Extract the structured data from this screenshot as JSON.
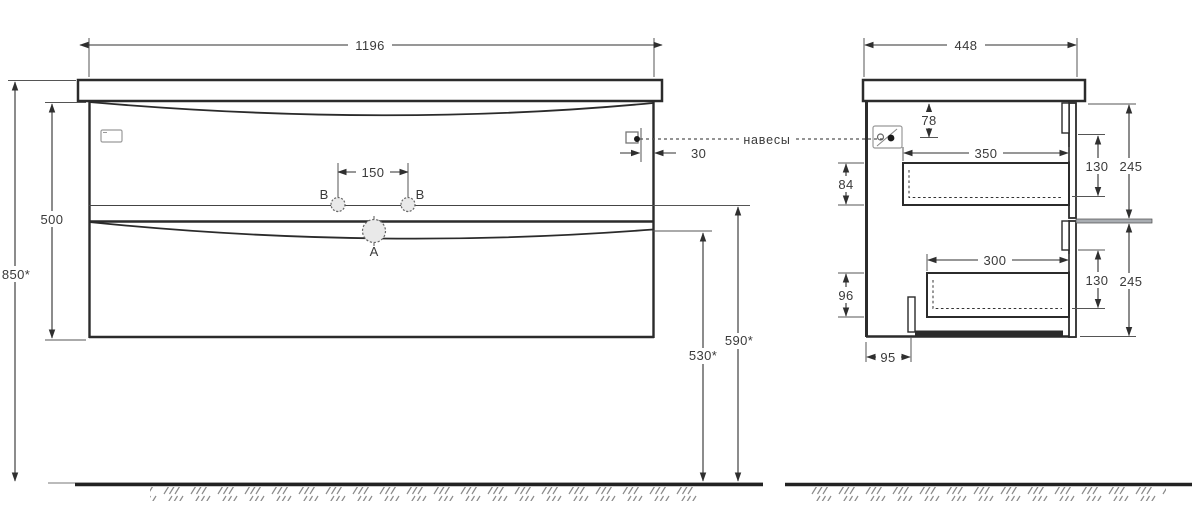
{
  "drawing": {
    "front_view": {
      "width": "1196",
      "body_height": "500",
      "installation_height": "850*",
      "faucet_hole_spacing": "150",
      "hanger_edge_offset": "30",
      "groove_height_from_floor": "530*",
      "drawer_gap_height_from_floor": "590*",
      "hole_label_a": "A",
      "hole_label_b_left": "B",
      "hole_label_b_right": "B"
    },
    "side_view": {
      "depth": "448",
      "hanger_from_top": "78",
      "upper_drawer_inner_height": "84",
      "lower_drawer_inner_height": "96",
      "upper_drawer_inner_depth": "350",
      "lower_drawer_inner_depth": "300",
      "upper_front_recess": "130",
      "upper_front_height": "245",
      "lower_front_recess": "130",
      "lower_front_height": "245",
      "bottom_service_setback": "95"
    },
    "annotations": {
      "hangers_label": "навесы"
    },
    "colors": {
      "outline": "#2b2b2b",
      "dimension": "#3a3a3a",
      "ground_hatch": "#8a8a8a",
      "gray_divider": "#a9adb2",
      "background": "#ffffff"
    }
  }
}
